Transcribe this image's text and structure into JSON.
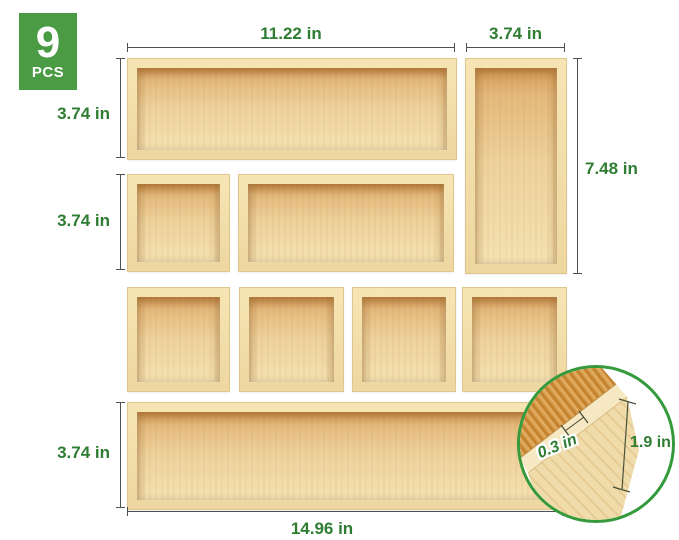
{
  "badge": {
    "count": "9",
    "unit": "PCS"
  },
  "labels": {
    "top_long_width": "11.22 in",
    "top_right_width": "3.74 in",
    "row1_height": "3.74 in",
    "row2_height": "3.74 in",
    "right_column_height": "7.48 in",
    "bottom_row_height": "3.74 in",
    "bottom_row_width": "14.96 in",
    "wall_thickness": "0.3 in",
    "wall_height": "1.9 in"
  },
  "colors": {
    "badge_green": "#4a9b44",
    "label_green": "#2e7d32",
    "dim_line": "#4f4f4f",
    "inset_ring_green": "#349a3c"
  }
}
